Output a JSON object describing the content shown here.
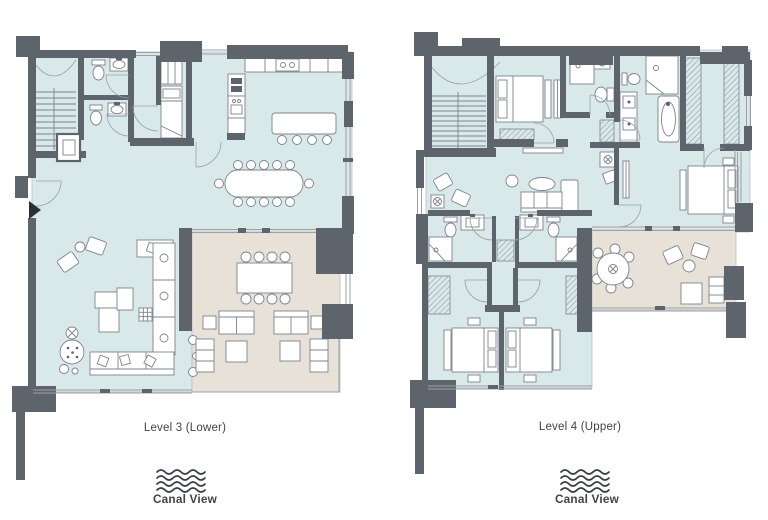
{
  "plans": [
    {
      "id": "level-3-lower",
      "label": "Level 3 (Lower)",
      "view_label": "Canal View"
    },
    {
      "id": "level-4-upper",
      "label": "Level 4 (Upper)",
      "view_label": "Canal View"
    }
  ],
  "colors": {
    "wall": "#5e646b",
    "interior": "#d9e8e9",
    "terrace": "#e7e1d8",
    "furniture_line": "#7c848c",
    "thin_line": "#9aa0a6",
    "fixture_fill": "#ffffff",
    "label_text": "#3f444a",
    "wave_icon": "#3a3f45",
    "page_bg": "#ffffff",
    "entry_marker": "#2b3036"
  }
}
